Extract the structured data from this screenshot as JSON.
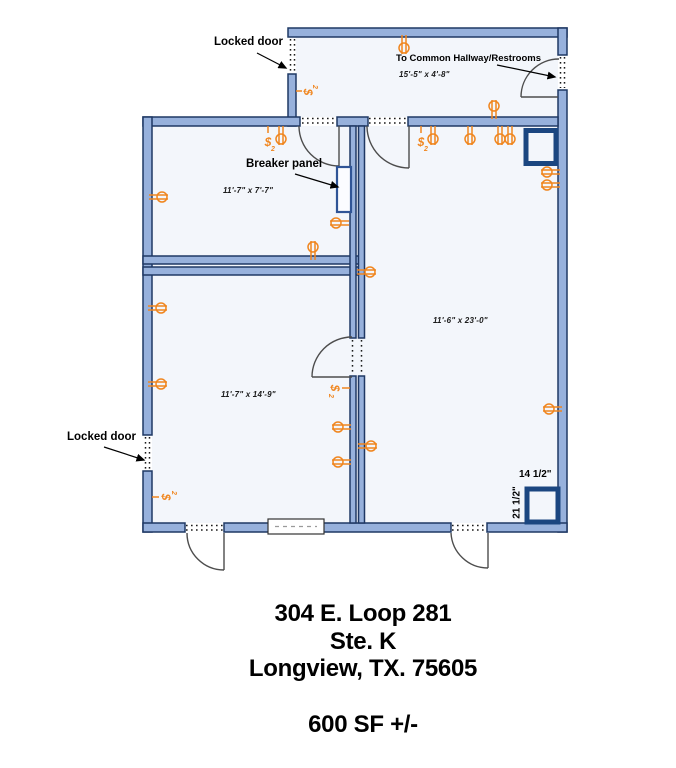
{
  "floor_plan": {
    "labels": {
      "locked_door_top": "Locked door",
      "locked_door_left": "Locked door",
      "common_hallway": "To Common Hallway/Restrooms",
      "breaker_panel": "Breaker panel",
      "chase_width": "14 1/2\"",
      "chase_depth": "21 1/2\""
    },
    "rooms": {
      "hallway": {
        "dimensions": "15'-5\" x 4'-8\""
      },
      "office_top_left": {
        "dimensions": "11'-7\" x 7'-7\""
      },
      "main_right": {
        "dimensions": "11'-6\" x 23'-0\""
      },
      "office_bottom_left": {
        "dimensions": "11'-7\" x 14'-9\""
      }
    },
    "symbols": {
      "outlet": "duplex-outlet-icon",
      "switch": "wall-switch-icon"
    }
  },
  "address": {
    "line1": "304 E. Loop 281",
    "line2": "Ste. K",
    "line3": "Longview, TX. 75605",
    "area": "600 SF +/-"
  },
  "colors": {
    "wall_fill": "#97B1DC",
    "wall_stroke": "#1F3864",
    "floor": "#F3F6FB",
    "chase_navy": "#1B4680",
    "breaker_blue": "#2F5496",
    "symbol_orange": "#F0861F",
    "swing_gray": "#4D4D4D",
    "text_black": "#000000"
  }
}
